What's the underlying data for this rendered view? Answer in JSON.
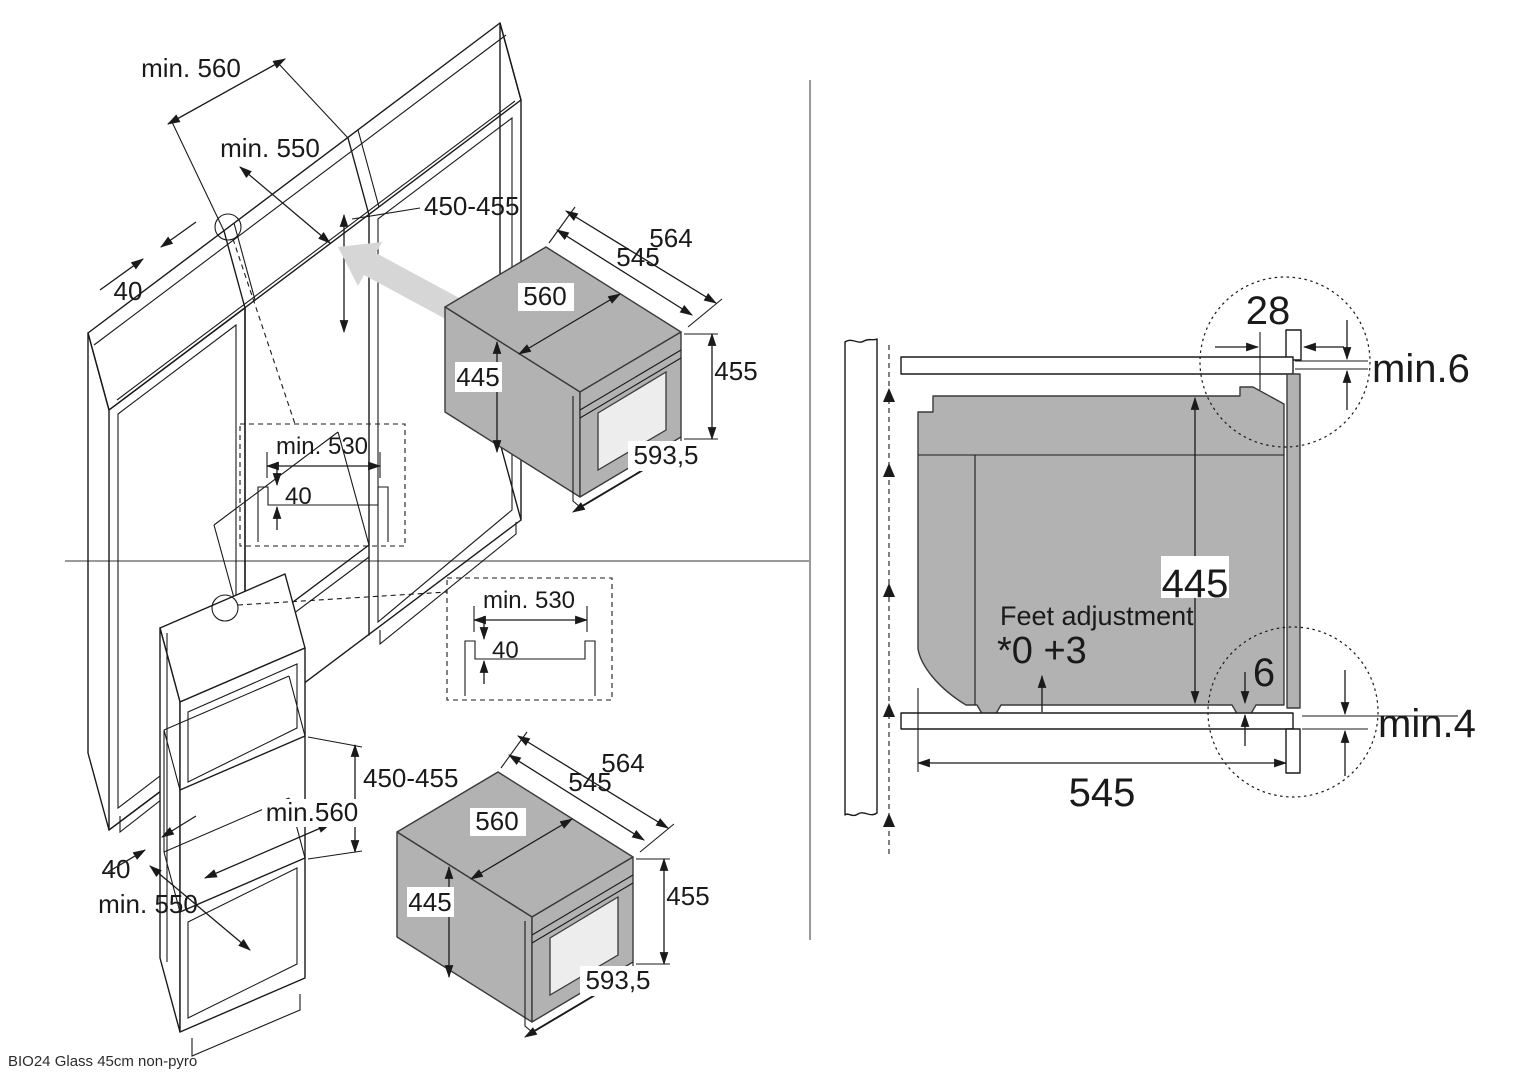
{
  "caption": "BIO24 Glass 45cm non-pyro",
  "base_cabinet_view": {
    "niche_width_label": "min. 560",
    "niche_depth_label": "min. 550",
    "niche_height_label": "450-455",
    "rail_width_label": "40"
  },
  "tall_cabinet_view": {
    "niche_height_label": "450-455",
    "niche_width_label": "min.560",
    "rail_width_label": "40",
    "niche_depth_label": "min. 550"
  },
  "cutout_detail": {
    "width_label": "min. 530",
    "depth_label": "40"
  },
  "oven": {
    "outer_depth": "564",
    "inner_depth": "545",
    "body_width": "560",
    "body_height": "445",
    "front_height": "455",
    "front_width": "593,5"
  },
  "side_section": {
    "front_frame_depth": "28",
    "top_clearance": "min.6",
    "body_height": "445",
    "feet_title": "Feet adjustment",
    "feet_range": "*0 +3",
    "bottom_gap": "6",
    "bottom_clearance": "min.4",
    "body_depth": "545"
  },
  "colors": {
    "oven_body_gray": "#b2b2b2",
    "insert_arrow_gray": "#d6d6d6",
    "line_black": "#1a1a1a",
    "window_glass": "#ededed",
    "divider_gray": "#9a9a9a"
  }
}
